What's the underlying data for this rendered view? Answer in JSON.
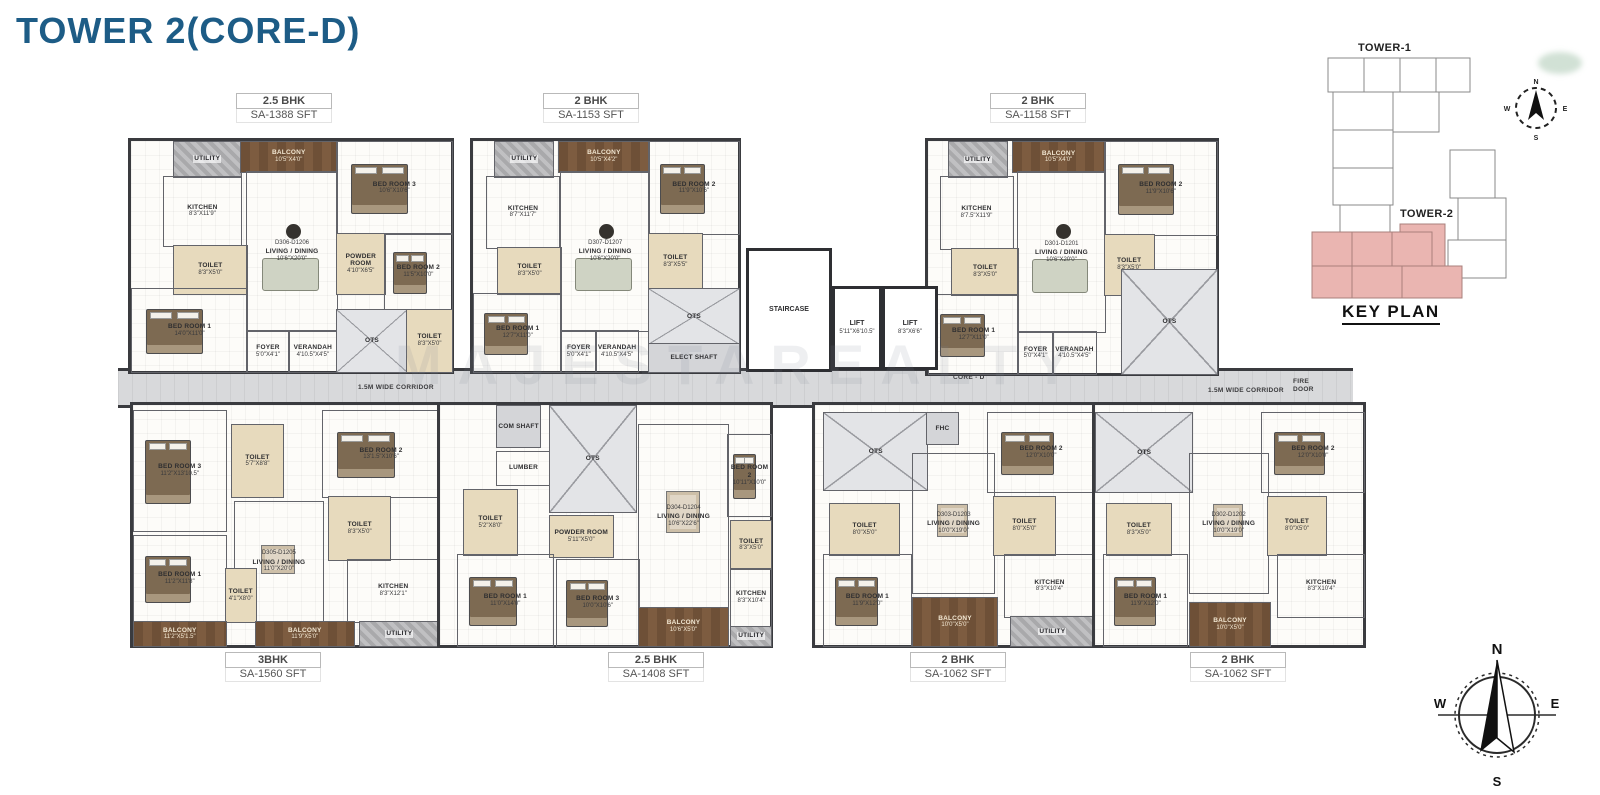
{
  "page": {
    "title": "TOWER 2(CORE-D)",
    "watermark": "MAJESTAREALTY"
  },
  "corridor": {
    "label_left": "1.5M WIDE CORRIDOR",
    "label_right": "1.5M WIDE CORRIDOR",
    "core_label": "CORE - D",
    "fire_door": "FIRE DOOR",
    "up": "UP",
    "dn": "DN"
  },
  "core": {
    "staircase": "STAIRCASE",
    "lift1": {
      "name": "LIFT",
      "dims": "5'11\"X6'10.5\""
    },
    "lift2": {
      "name": "LIFT",
      "dims": "8'3\"X6'6\""
    }
  },
  "key_plan": {
    "tower1_label": "TOWER-1",
    "tower2_label": "TOWER-2",
    "title": "KEY PLAN",
    "highlight_color": "#eab5b1"
  },
  "compass": {
    "n": "N",
    "s": "S",
    "e": "E",
    "w": "W"
  },
  "units": [
    {
      "id": "unit-d306",
      "type": "2.5 BHK",
      "area": "SA-1388 SFT",
      "unit_no": "D306-D1206",
      "rooms": [
        {
          "name": "UTILITY",
          "dims": "",
          "box": [
            13,
            0,
            21,
            15
          ],
          "fill": "util"
        },
        {
          "name": "BALCONY",
          "dims": "10'5\"X4'0\"",
          "box": [
            34,
            0,
            30,
            13
          ],
          "fill": "deck"
        },
        {
          "name": "BED ROOM 3",
          "dims": "10'6\"X10'6\"",
          "box": [
            64,
            0,
            36,
            40
          ],
          "furn": "bed"
        },
        {
          "name": "KITCHEN",
          "dims": "8'3\"X11'9\"",
          "box": [
            10,
            15,
            24,
            30
          ]
        },
        {
          "name": "TOILET",
          "dims": "8'3\"X5'0\"",
          "box": [
            13,
            45,
            23,
            21
          ],
          "fill": "beige"
        },
        {
          "name": "LIVING / DINING",
          "dims": "10'6\"X20'0\"",
          "no": "D306-D1206",
          "box": [
            36,
            13,
            28,
            69
          ],
          "furn": "sofa"
        },
        {
          "name": "POWDER ROOM",
          "dims": "4'10\"X6'5\"",
          "box": [
            64,
            40,
            15,
            26
          ],
          "fill": "beige"
        },
        {
          "name": "BED ROOM 2",
          "dims": "11'5\"X10'0\"",
          "box": [
            79,
            40,
            21,
            33
          ],
          "furn": "bed"
        },
        {
          "name": "BED ROOM 1",
          "dims": "14'0\"X11'0\"",
          "box": [
            0,
            64,
            36,
            36
          ],
          "furn": "bed"
        },
        {
          "name": "FOYER",
          "dims": "5'0\"X4'1\"",
          "box": [
            36,
            82,
            13,
            18
          ]
        },
        {
          "name": "VERANDAH",
          "dims": "4'10.5\"X4'5\"",
          "box": [
            49,
            82,
            15,
            18
          ]
        },
        {
          "name": "OTS",
          "dims": "",
          "box": [
            64,
            73,
            22,
            27
          ],
          "fill": "ots"
        },
        {
          "name": "TOILET",
          "dims": "8'3\"X5'0\"",
          "box": [
            86,
            73,
            14,
            27
          ],
          "fill": "beige"
        }
      ]
    },
    {
      "id": "unit-d307",
      "type": "2 BHK",
      "area": "SA-1153 SFT",
      "unit_no": "D307-D1207",
      "rooms": [
        {
          "name": "UTILITY",
          "dims": "",
          "box": [
            8,
            0,
            22,
            15
          ],
          "fill": "util"
        },
        {
          "name": "BALCONY",
          "dims": "10'5\"X4'2\"",
          "box": [
            32,
            0,
            34,
            13
          ],
          "fill": "deck"
        },
        {
          "name": "BED ROOM 2",
          "dims": "11'9\"X10'6\"",
          "box": [
            66,
            0,
            34,
            40
          ],
          "furn": "bed"
        },
        {
          "name": "KITCHEN",
          "dims": "8'7\"X11'7\"",
          "box": [
            5,
            15,
            27,
            31
          ]
        },
        {
          "name": "TOILET",
          "dims": "8'3\"X5'0\"",
          "box": [
            9,
            46,
            24,
            20
          ],
          "fill": "beige"
        },
        {
          "name": "LIVING / DINING",
          "dims": "10'6\"X20'0\"",
          "no": "D307-D1207",
          "box": [
            33,
            13,
            33,
            69
          ],
          "furn": "sofa"
        },
        {
          "name": "TOILET",
          "dims": "8'3\"X5'5\"",
          "box": [
            66,
            40,
            20,
            24
          ],
          "fill": "beige"
        },
        {
          "name": "BED ROOM 1",
          "dims": "12'7\"X11'0\"",
          "box": [
            0,
            66,
            33,
            34
          ],
          "furn": "bed"
        },
        {
          "name": "FOYER",
          "dims": "5'0\"X4'1\"",
          "box": [
            33,
            82,
            13,
            18
          ]
        },
        {
          "name": "VERANDAH",
          "dims": "4'10.5\"X4'5\"",
          "box": [
            46,
            82,
            16,
            18
          ]
        },
        {
          "name": "OTS",
          "dims": "",
          "box": [
            66,
            64,
            34,
            24
          ],
          "fill": "ots"
        },
        {
          "name": "ELECT SHAFT",
          "dims": "",
          "box": [
            66,
            88,
            34,
            12
          ],
          "fill": "shaft"
        }
      ]
    },
    {
      "id": "unit-d301",
      "type": "2 BHK",
      "area": "SA-1158 SFT",
      "unit_no": "D301-D1201",
      "rooms": [
        {
          "name": "UTILITY",
          "dims": "",
          "box": [
            7,
            0,
            20,
            15
          ],
          "fill": "util"
        },
        {
          "name": "BALCONY",
          "dims": "10'5\"X4'0\"",
          "box": [
            29,
            0,
            32,
            13
          ],
          "fill": "deck"
        },
        {
          "name": "BED ROOM 2",
          "dims": "11'9\"X10'6\"",
          "box": [
            61,
            0,
            39,
            40
          ],
          "furn": "bed"
        },
        {
          "name": "KITCHEN",
          "dims": "8'7.5\"X11'9\"",
          "box": [
            4,
            15,
            25,
            31
          ]
        },
        {
          "name": "TOILET",
          "dims": "8'3\"X5'0\"",
          "box": [
            8,
            46,
            23,
            20
          ],
          "fill": "beige"
        },
        {
          "name": "LIVING / DINING",
          "dims": "10'6\"X20'0\"",
          "no": "D301-D1201",
          "box": [
            31,
            13,
            30,
            69
          ],
          "furn": "sofa"
        },
        {
          "name": "TOILET",
          "dims": "8'3\"X5'0\"",
          "box": [
            61,
            40,
            17,
            26
          ],
          "fill": "beige"
        },
        {
          "name": "BED ROOM 1",
          "dims": "12'7\"X11'0\"",
          "box": [
            0,
            66,
            31,
            34
          ],
          "furn": "bed"
        },
        {
          "name": "FOYER",
          "dims": "5'0\"X4'1\"",
          "box": [
            31,
            82,
            12,
            18
          ]
        },
        {
          "name": "VERANDAH",
          "dims": "4'10.5\"X4'5\"",
          "box": [
            43,
            82,
            15,
            18
          ]
        },
        {
          "name": "OTS",
          "dims": "",
          "box": [
            67,
            55,
            33,
            45
          ],
          "fill": "ots"
        }
      ]
    },
    {
      "id": "unit-d305",
      "type": "3BHK",
      "area": "SA-1560 SFT",
      "unit_no": "D305-D1205",
      "rooms": [
        {
          "name": "BED ROOM 3",
          "dims": "11'2\"X13'10.5\"",
          "box": [
            0,
            2,
            30,
            50
          ],
          "furn": "bed"
        },
        {
          "name": "TOILET",
          "dims": "5'7\"X8'8\"",
          "box": [
            32,
            8,
            17,
            30
          ],
          "fill": "beige"
        },
        {
          "name": "BED ROOM 2",
          "dims": "13'1.5\"X10'6\"",
          "box": [
            62,
            2,
            38,
            36
          ],
          "furn": "bed"
        },
        {
          "name": "LIVING / DINING",
          "dims": "11'0\"X20'0\"",
          "no": "D305-D1205",
          "box": [
            33,
            40,
            29,
            50
          ],
          "furn": "dine"
        },
        {
          "name": "TOILET",
          "dims": "8'3\"X5'0\"",
          "box": [
            64,
            38,
            20,
            26
          ],
          "fill": "beige"
        },
        {
          "name": "BED ROOM 1",
          "dims": "11'2\"X11'8\"",
          "box": [
            0,
            54,
            30,
            36
          ],
          "furn": "bed"
        },
        {
          "name": "TOILET",
          "dims": "4'1\"X8'0\"",
          "box": [
            30,
            68,
            10,
            22
          ],
          "fill": "beige"
        },
        {
          "name": "KITCHEN",
          "dims": "8'3\"X12'1\"",
          "box": [
            70,
            64,
            30,
            26
          ]
        },
        {
          "name": "BALCONY",
          "dims": "11'2\"X5'1.5\"",
          "box": [
            0,
            90,
            30,
            10
          ],
          "fill": "deck"
        },
        {
          "name": "BALCONY",
          "dims": "11'9\"X5'0\"",
          "box": [
            40,
            90,
            32,
            10
          ],
          "fill": "deck"
        },
        {
          "name": "UTILITY",
          "dims": "",
          "box": [
            74,
            90,
            26,
            10
          ],
          "fill": "util"
        }
      ]
    },
    {
      "id": "unit-d304",
      "type": "2.5 BHK",
      "area": "SA-1408 SFT",
      "unit_no": "D304-D1204",
      "rooms": [
        {
          "name": "COM SHAFT",
          "dims": "",
          "box": [
            17,
            0,
            13,
            17
          ],
          "fill": "shaft"
        },
        {
          "name": "LUMBER",
          "dims": "",
          "box": [
            17,
            19,
            16,
            14
          ]
        },
        {
          "name": "OTS",
          "dims": "",
          "box": [
            33,
            0,
            26,
            44
          ],
          "fill": "ots"
        },
        {
          "name": "TOILET",
          "dims": "5'2\"X8'0\"",
          "box": [
            7,
            35,
            16,
            27
          ],
          "fill": "beige"
        },
        {
          "name": "POWDER ROOM",
          "dims": "5'11\"X5'0\"",
          "box": [
            33,
            46,
            19,
            17
          ],
          "fill": "beige"
        },
        {
          "name": "BED ROOM 1",
          "dims": "11'0\"X14'0\"",
          "box": [
            5,
            62,
            29,
            38
          ],
          "furn": "bed"
        },
        {
          "name": "BED ROOM 3",
          "dims": "10'0\"X10'6\"",
          "box": [
            35,
            64,
            25,
            36
          ],
          "furn": "bed"
        },
        {
          "name": "LIVING / DINING",
          "dims": "10'6\"X22'6\"",
          "no": "D304-D1204",
          "box": [
            60,
            8,
            27,
            76
          ],
          "furn": "dine"
        },
        {
          "name": "BED ROOM 2",
          "dims": "10'11\"X10'0\"",
          "box": [
            87,
            12,
            13,
            34
          ],
          "furn": "bed"
        },
        {
          "name": "TOILET",
          "dims": "8'3\"X5'0\"",
          "box": [
            88,
            48,
            12,
            20
          ],
          "fill": "beige"
        },
        {
          "name": "KITCHEN",
          "dims": "8'3\"X10'4\"",
          "box": [
            88,
            68,
            12,
            24
          ]
        },
        {
          "name": "BALCONY",
          "dims": "10'6\"X5'0\"",
          "box": [
            60,
            84,
            27,
            16
          ],
          "fill": "deck"
        },
        {
          "name": "UTILITY",
          "dims": "",
          "box": [
            88,
            92,
            12,
            8
          ],
          "fill": "util"
        }
      ]
    },
    {
      "id": "unit-d303",
      "type": "2 BHK",
      "area": "SA-1062 SFT",
      "unit_no": "D303-D1203",
      "rooms": [
        {
          "name": "OTS",
          "dims": "",
          "box": [
            3,
            3,
            37,
            32
          ],
          "fill": "ots"
        },
        {
          "name": "FHC",
          "dims": "",
          "box": [
            40,
            3,
            11,
            13
          ],
          "fill": "shaft"
        },
        {
          "name": "BED ROOM 2",
          "dims": "12'0\"X10'0\"",
          "box": [
            62,
            3,
            38,
            33
          ],
          "furn": "bed"
        },
        {
          "name": "TOILET",
          "dims": "8'0\"X5'0\"",
          "box": [
            5,
            41,
            25,
            21
          ],
          "fill": "beige"
        },
        {
          "name": "LIVING / DINING",
          "dims": "10'0\"X19'0\"",
          "no": "D303-D1203",
          "box": [
            35,
            20,
            29,
            58
          ],
          "furn": "dine"
        },
        {
          "name": "TOILET",
          "dims": "8'0\"X5'0\"",
          "box": [
            64,
            38,
            22,
            24
          ],
          "fill": "beige"
        },
        {
          "name": "BED ROOM 1",
          "dims": "11'9\"X12'0\"",
          "box": [
            3,
            62,
            31,
            38
          ],
          "furn": "bed"
        },
        {
          "name": "KITCHEN",
          "dims": "8'3\"X10'4\"",
          "box": [
            68,
            62,
            32,
            26
          ]
        },
        {
          "name": "BALCONY",
          "dims": "10'0\"X5'0\"",
          "box": [
            35,
            80,
            30,
            20
          ],
          "fill": "deck"
        },
        {
          "name": "UTILITY",
          "dims": "",
          "box": [
            70,
            88,
            30,
            12
          ],
          "fill": "util"
        }
      ]
    },
    {
      "id": "unit-d302",
      "type": "2 BHK",
      "area": "SA-1062 SFT",
      "unit_no": "D302-D1202",
      "rooms": [
        {
          "name": "OTS",
          "dims": "",
          "box": [
            0,
            3,
            36,
            33
          ],
          "fill": "ots"
        },
        {
          "name": "BED ROOM 2",
          "dims": "12'0\"X10'0\"",
          "box": [
            62,
            3,
            38,
            33
          ],
          "furn": "bed"
        },
        {
          "name": "TOILET",
          "dims": "8'3\"X5'0\"",
          "box": [
            4,
            41,
            24,
            21
          ],
          "fill": "beige"
        },
        {
          "name": "LIVING / DINING",
          "dims": "10'0\"X19'0\"",
          "no": "D302-D1202",
          "box": [
            35,
            20,
            29,
            58
          ],
          "furn": "dine"
        },
        {
          "name": "TOILET",
          "dims": "8'0\"X5'0\"",
          "box": [
            64,
            38,
            22,
            24
          ],
          "fill": "beige"
        },
        {
          "name": "BED ROOM 1",
          "dims": "11'9\"X12'0\"",
          "box": [
            3,
            62,
            31,
            38
          ],
          "furn": "bed"
        },
        {
          "name": "KITCHEN",
          "dims": "8'3\"X10'4\"",
          "box": [
            68,
            62,
            32,
            26
          ]
        },
        {
          "name": "BALCONY",
          "dims": "10'0\"X5'0\"",
          "box": [
            35,
            82,
            30,
            18
          ],
          "fill": "deck"
        }
      ]
    }
  ]
}
